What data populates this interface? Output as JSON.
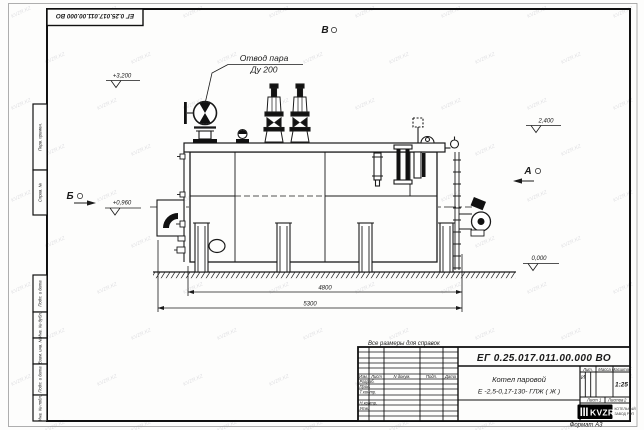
{
  "watermark": "KVZR.KZ",
  "frame": {
    "flipped_designation": "ЕГ 0.25.017.011.00.000  ВО",
    "stamps": [
      "Перв. примен.",
      "Справ. №",
      "Подп. и дата",
      "Инв. № дубл.",
      "Взам. инв. №",
      "Подп. и дата",
      "Инв. № подл."
    ],
    "format_note": "Формат А3"
  },
  "annotations": {
    "steam_note_line1": "Отвод пара",
    "steam_note_line2": "Ду 200",
    "view_top": "В",
    "view_left": "Б",
    "view_right": "А",
    "elev_top": "+3,200",
    "elev_right_top": "2,400",
    "elev_burner": "+0,960",
    "elev_ground": "0,000",
    "dim_inner": "4800",
    "dim_overall": "5300",
    "ref_note": "Все размеры для справок"
  },
  "titleblock": {
    "designation": "ЕГ 0.25.017.011.00.000  ВО",
    "product_line1": "Котел паровой",
    "product_line2": "Е -2,5-0,17-130- ГЛЖ ( Ж )",
    "header": {
      "izm": "Изм.",
      "list": "Лист",
      "ndoc": "N докум.",
      "podp": "Подп.",
      "data": "Дата"
    },
    "rows": [
      "Разраб.",
      "Пров.",
      "Т.контр.",
      "Н.контр.",
      "Утв."
    ],
    "lit_label": "Лит.",
    "lit_value": "И",
    "massa_label": "Масса",
    "masshtab_label": "Масштаб",
    "masshtab_value": "1:25",
    "list_label": "Лист",
    "list_value": "1",
    "listov_label": "Листов",
    "listov_value": "2",
    "logo_text": "KVZR",
    "logo_sub1": "КОТЕЛЬНЫЙ",
    "logo_sub2": "ЗАВОД РЭП"
  }
}
